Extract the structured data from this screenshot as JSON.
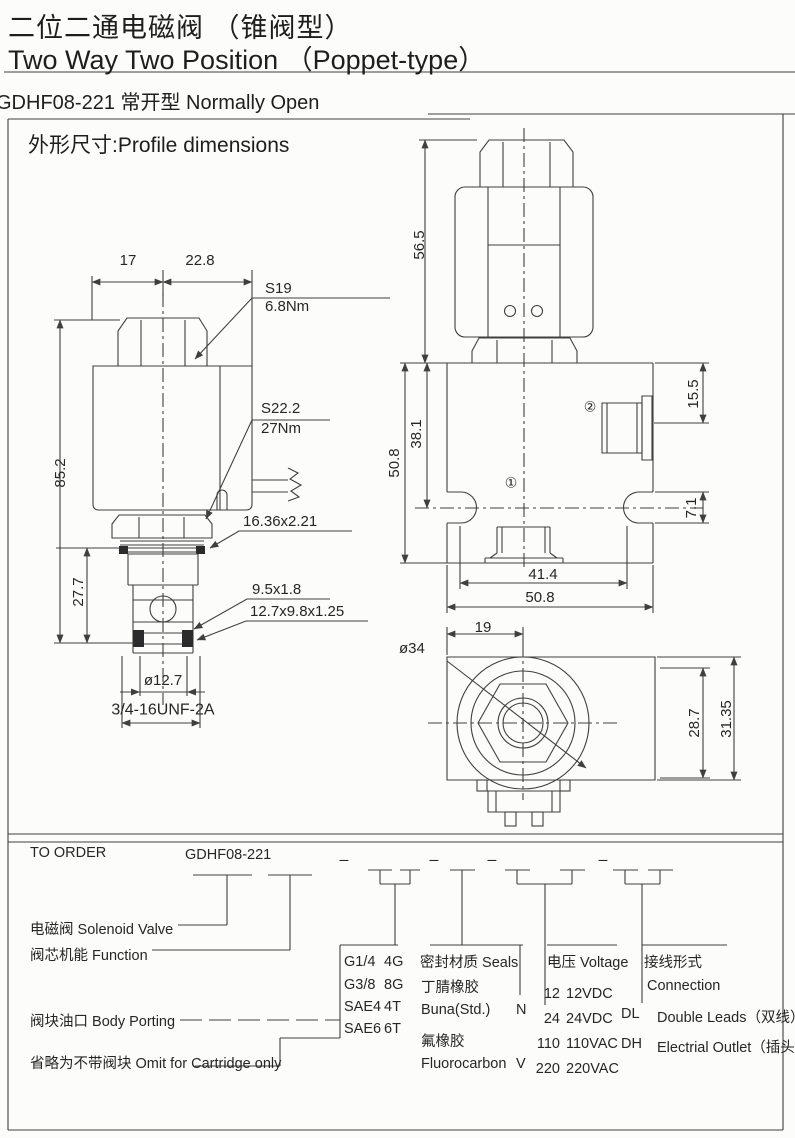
{
  "header": {
    "title_zh": "二位二通电磁阀 （锥阀型）",
    "title_en": "Two Way Two Position （Poppet-type）",
    "model_line": "GDHF08-221  常开型 Normally Open",
    "section_heading": "外形尺寸:Profile dimensions"
  },
  "front_view": {
    "dim_width_left": "17",
    "dim_width_right": "22.8",
    "hex_size": "S19",
    "hex_torque": "6.8Nm",
    "locknut_size": "S22.2",
    "locknut_torque": "27Nm",
    "dim_total_height": "85.2",
    "dim_cartridge_height": "27.7",
    "oring_main": "16.36x2.21",
    "oring_nose": "9.5x1.8",
    "seal_pack": "12.7x9.8x1.25",
    "nose_diameter": "ø12.7",
    "thread": "3/4-16UNF-2A"
  },
  "side_view": {
    "dim_coil_height": "56.5",
    "dim_body_outer": "50.8",
    "dim_body_inner": "38.1",
    "dim_port2_offset": "15.5",
    "dim_slot_width": "7.1",
    "dim_port_span": "41.4",
    "dim_body_width": "50.8",
    "port1_marker": "①",
    "port2_marker": "②"
  },
  "top_view": {
    "dim_offset": "19",
    "coil_diameter": "ø34",
    "dim_inner_height": "28.7",
    "dim_outer_height": "31.35"
  },
  "order": {
    "heading": "TO ORDER",
    "model": "GDHF08-221",
    "dash": "–",
    "solenoid_label": "电磁阀 Solenoid Valve",
    "function_label": "阀芯机能 Function",
    "porting_label": "阀块油口 Body Porting",
    "omit_label": "省略为不带阀块 Omit for Cartridge only",
    "porting": {
      "rows": [
        {
          "size": "G1/4",
          "code": "4G"
        },
        {
          "size": "G3/8",
          "code": "8G"
        },
        {
          "size": "SAE4",
          "code": "4T"
        },
        {
          "size": "SAE6",
          "code": "6T"
        }
      ]
    },
    "seals": {
      "header": "密封材质 Seals",
      "rows": [
        {
          "zh": "丁腈橡胶",
          "en": "Buna(Std.)",
          "code": "N"
        },
        {
          "zh": "氟橡胶",
          "en": "Fluorocarbon",
          "code": "V"
        }
      ]
    },
    "voltage": {
      "header": "电压 Voltage",
      "rows": [
        {
          "code": "12",
          "desc": "12VDC"
        },
        {
          "code": "24",
          "desc": "24VDC"
        },
        {
          "code": "110",
          "desc": "110VAC"
        },
        {
          "code": "220",
          "desc": "220VAC"
        }
      ]
    },
    "connection": {
      "header_zh": "接线形式",
      "header_en": "Connection",
      "rows": [
        {
          "code": "DL",
          "desc": "Double Leads（双线）"
        },
        {
          "code": "DH",
          "desc": "Electrial Outlet（插头）"
        }
      ]
    }
  }
}
